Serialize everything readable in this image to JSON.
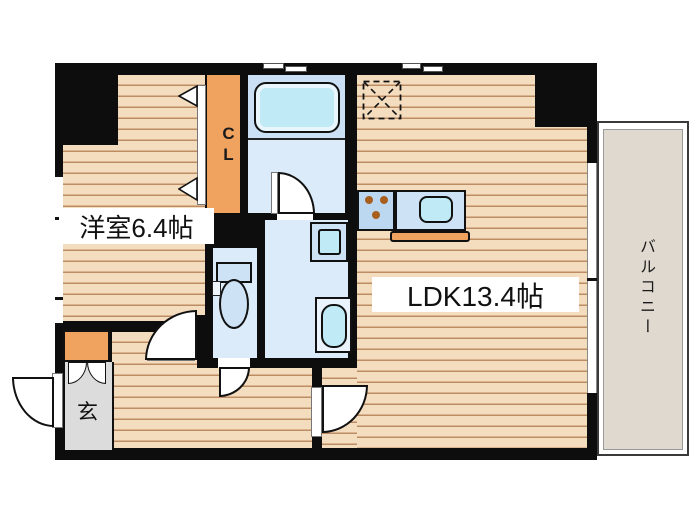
{
  "floorplan": {
    "type": "apartment-floor-plan",
    "rooms": {
      "western_room": {
        "label": "洋室6.4帖"
      },
      "ldk": {
        "label": "LDK13.4帖"
      },
      "closet": {
        "label": "CL"
      },
      "entrance": {
        "label": "玄"
      },
      "balcony": {
        "label": "バルコニー"
      }
    },
    "fixtures": [
      "bathtub",
      "bathroom-door",
      "washing-machine-pan",
      "vanity-sink",
      "toilet",
      "gas-stove-3-burner",
      "kitchen-sink",
      "refrigerator-space",
      "shoe-cabinet",
      "entrance-door",
      "closet-folding-door",
      "windows"
    ],
    "colors": {
      "wall": "#0d0d0d",
      "wood_floor": "#f4dcbf",
      "wood_stripe": "#bd8c62",
      "wet_room_floor": "#dcebfa",
      "bath_upper": "#cbe0f4",
      "fixture_blue": "#cde2f5",
      "aqua": "#bfeaf6",
      "accent_orange": "#f0a35f",
      "entrance_gray": "#dcdcdc",
      "balcony_beige": "#e0d9d0",
      "burner_brown": "#a85f1e"
    }
  }
}
